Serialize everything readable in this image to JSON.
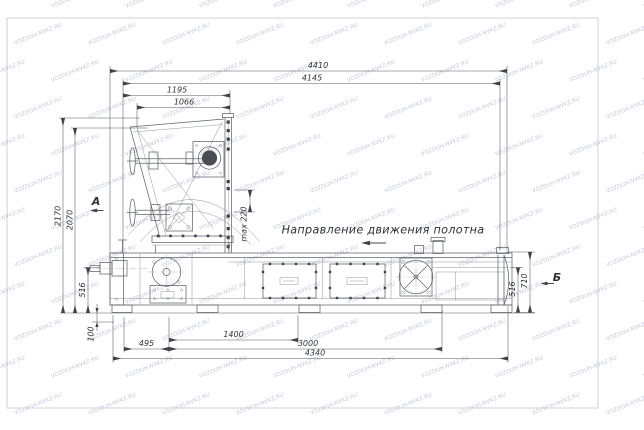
{
  "watermark": {
    "text": "VOZDUH-NVKZ.RU",
    "color": "#c4c9da"
  },
  "colors": {
    "line": "#60646b",
    "dark": "#3f4248",
    "dim_text": "#2e3136",
    "frame": "#cdd0d6"
  },
  "drawing": {
    "direction_label": "Направление движения полотна",
    "views": {
      "a": "А",
      "b": "Б"
    },
    "dims": {
      "d4410": "4410",
      "d4145": "4145",
      "d1195": "1195",
      "d1066": "1066",
      "d2170": "2170",
      "d2070": "2070",
      "d516_left": "516",
      "d100": "100",
      "d495": "495",
      "d1400": "1400",
      "d3000": "3000",
      "d4340": "4340",
      "dmax220": "max 220",
      "d710": "710",
      "d516_right": "516"
    }
  }
}
